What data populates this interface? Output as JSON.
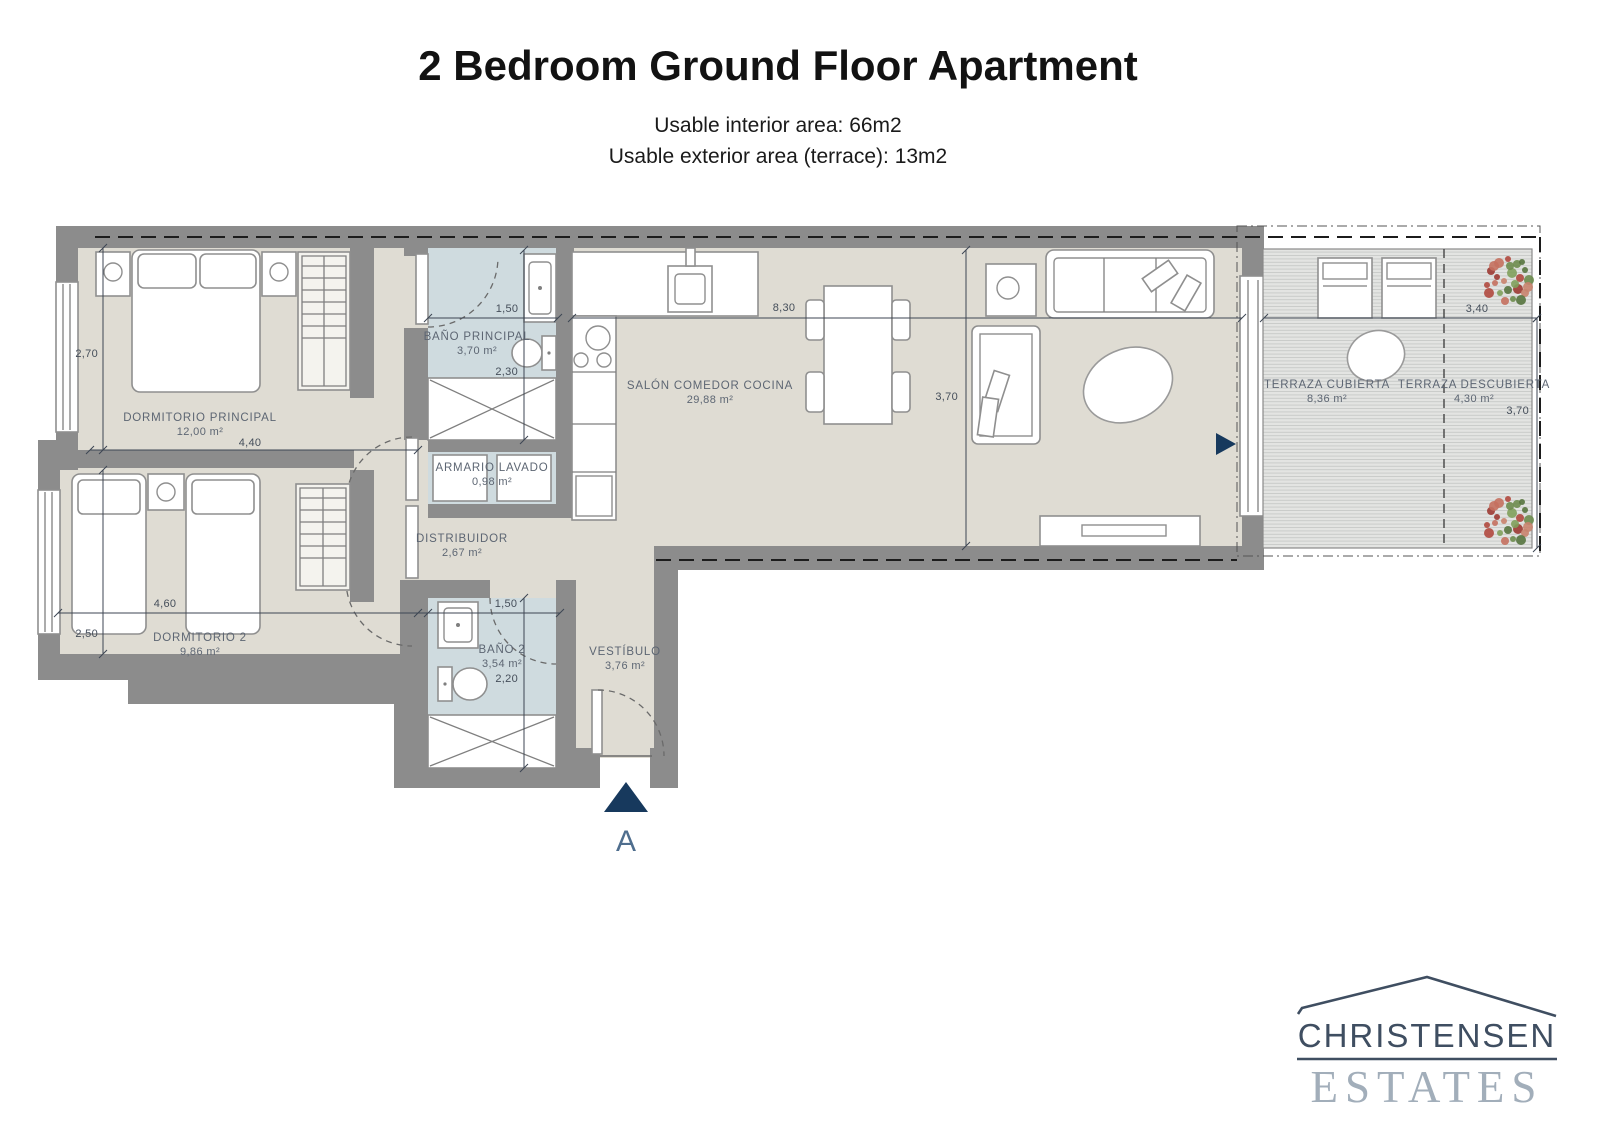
{
  "header": {
    "title": "2 Bedroom Ground Floor Apartment",
    "subtitle_line1": "Usable interior area: 66m2",
    "subtitle_line2": "Usable exterior area (terrace): 13m2"
  },
  "rooms": {
    "dormitorio_principal": {
      "name": "DORMITORIO PRINCIPAL",
      "area": "12,00 m²"
    },
    "bano_principal": {
      "name": "BAÑO PRINCIPAL",
      "area": "3,70 m²"
    },
    "armario_lavado": {
      "name": "ARMARIO LAVADO",
      "area": "0,98 m²"
    },
    "salon_comedor_cocina": {
      "name": "SALÓN COMEDOR COCINA",
      "area": "29,88 m²"
    },
    "distribuidor": {
      "name": "DISTRIBUIDOR",
      "area": "2,67 m²"
    },
    "dormitorio_2": {
      "name": "DORMITORIO 2",
      "area": "9,86 m²"
    },
    "bano_2": {
      "name": "BAÑO 2",
      "area": "3,54 m²"
    },
    "vestibulo": {
      "name": "VESTÍBULO",
      "area": "3,76 m²"
    },
    "terraza_cubierta": {
      "name": "TERRAZA CUBIERTA",
      "area": "8,36 m²"
    },
    "terraza_descubierta": {
      "name": "TERRAZA DESCUBIERTA",
      "area": "4,30 m²"
    }
  },
  "dimensions": {
    "dorm1_height": "2,70",
    "dorm1_width": "4,40",
    "dorm2_height": "2,50",
    "dorm2_width": "4,60",
    "bano1_width": "1,50",
    "bano1_height": "2,30",
    "salon_width": "8,30",
    "salon_height": "3,70",
    "bano2_width": "1,50",
    "bano2_height": "2,20",
    "terraza_width": "3,40",
    "terraza_height": "3,70"
  },
  "entrance": {
    "label": "A"
  },
  "logo": {
    "name": "CHRISTENSEN",
    "tagline": "ESTATES"
  },
  "colors": {
    "wall": "#8c8c8c",
    "floor": "#dfdcd3",
    "bath_floor": "#cfdbdf",
    "accent_navy": "#17395d",
    "label_text": "#5d6673",
    "logo_dark": "#3f4e61",
    "logo_light": "#a2aeba"
  }
}
